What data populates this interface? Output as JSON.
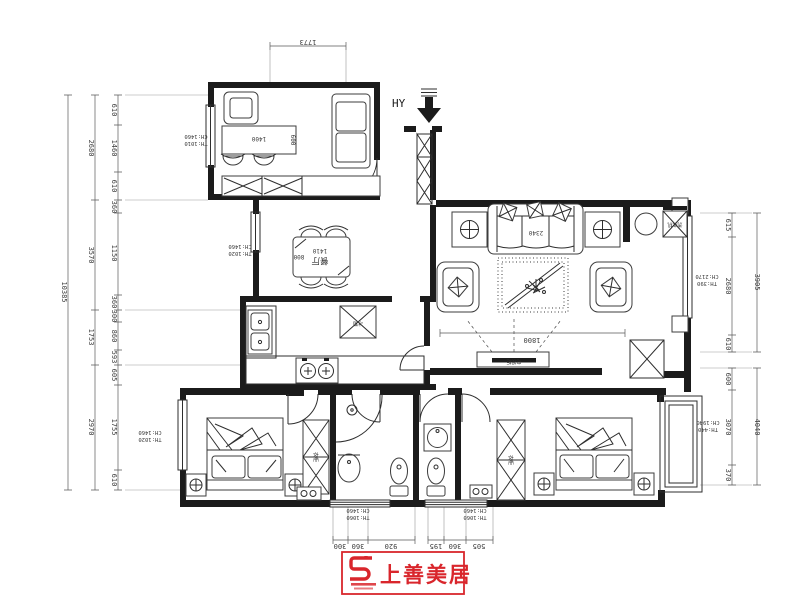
{
  "colors": {
    "ink": "#1b1b1b",
    "dim": "#5a5a5a",
    "logo_red": "#d9262c"
  },
  "north": {
    "label": "HY"
  },
  "logo": {
    "text": "上善美居"
  },
  "rooms": {
    "dining": "餐厅"
  },
  "furniture": {
    "wardrobe": "衣柜",
    "washer": "洗衣机",
    "fridge": "冰箱",
    "tv": "电视柜"
  },
  "dims": {
    "top": "1773",
    "left": {
      "overall": "10385",
      "c1": {
        "outer": "2680",
        "a": "610",
        "b": "1460",
        "c": "610"
      },
      "c2": {
        "outer": "3570",
        "a": "360",
        "b": "1150",
        "c": "360"
      },
      "c3": {
        "outer": "1753",
        "a": "300",
        "b": "860",
        "c": "593"
      },
      "c4": {
        "outer": "2970",
        "a": "605",
        "b": "1755",
        "c": "610"
      }
    },
    "right": {
      "c1": {
        "outer": "3905",
        "a": "615",
        "b": "2680",
        "c": "610"
      },
      "c2": {
        "outer": "4040",
        "a": "600",
        "b": "3070",
        "c": "370"
      }
    },
    "bottom": {
      "a": "300",
      "b": "360",
      "c": "920",
      "d": "195",
      "e": "360",
      "f": "505"
    },
    "living_width": "1800",
    "sofa_width": "2340",
    "table_len": "1410",
    "table_dep": "800",
    "desk_len": "1400",
    "desk_dep": "600"
  },
  "windows": {
    "w1": {
      "l1": "TH:1010",
      "l2": "CH:1460"
    },
    "w2": {
      "l1": "TH:1020",
      "l2": "CH:1460"
    },
    "w3": {
      "l1": "TH:1020",
      "l2": "CH:1460"
    },
    "w4": {
      "l1": "TH:390",
      "l2": "CH:2170"
    },
    "w5": {
      "l1": "TH:440",
      "l2": "CH:1940"
    },
    "w6": {
      "l1": "TH:1060",
      "l2": "CH:1460"
    },
    "w7": {
      "l1": "TH:1060",
      "l2": "CH:1460"
    }
  }
}
